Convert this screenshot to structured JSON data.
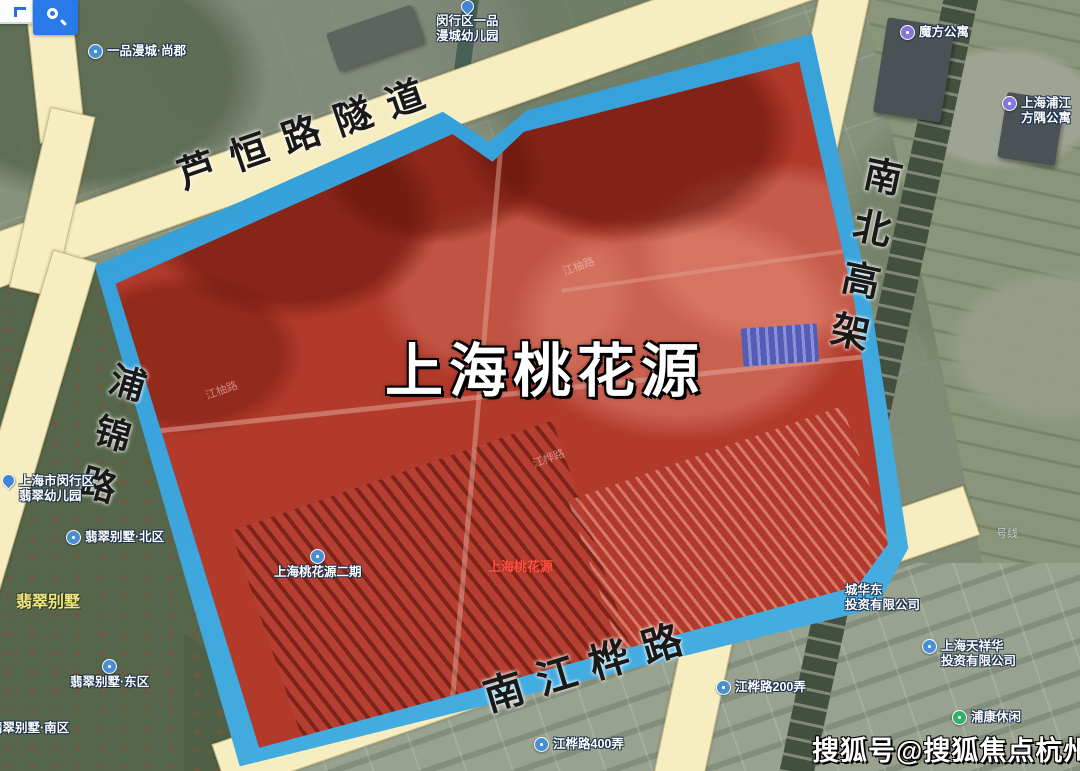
{
  "map": {
    "region": {
      "name": "上海桃花源",
      "overlay_color": "#b23a2b",
      "boundary_color": "#3aa9e0",
      "road_color": "#f6edc0"
    },
    "roads": [
      {
        "name": "芦恒路隧道"
      },
      {
        "name": "南北高架"
      },
      {
        "name": "浦锦路"
      },
      {
        "name": "南江桦路"
      }
    ],
    "pois": [
      {
        "id": "yipin-mancheng-shangjun",
        "lines": [
          "一品漫城·尚郡"
        ],
        "marker": "circle-blue",
        "markerPos": "left",
        "x": 88,
        "y": 44
      },
      {
        "id": "minhang-kindergarten",
        "lines": [
          "闵行区一品",
          "漫城幼儿园"
        ],
        "marker": "pin-blue",
        "markerPos": "above",
        "x": 436,
        "y": 0
      },
      {
        "id": "mofang-apartment",
        "lines": [
          "魔方公寓"
        ],
        "marker": "circle-purple",
        "markerPos": "left",
        "x": 900,
        "y": 25
      },
      {
        "id": "pujiang-funyard",
        "lines": [
          "上海浦江",
          "方隅公寓"
        ],
        "marker": "circle-purple",
        "markerPos": "left",
        "x": 1002,
        "y": 96
      },
      {
        "id": "feicui-kindergarten",
        "lines": [
          "上海市闵行区",
          "翡翠幼儿园"
        ],
        "marker": "pin-blue",
        "markerPos": "left",
        "x": 2,
        "y": 474
      },
      {
        "id": "feicui-villa-north",
        "lines": [
          "翡翠别墅·北区"
        ],
        "marker": "circle-blue",
        "markerPos": "left",
        "x": 66,
        "y": 530
      },
      {
        "id": "feicui-villa",
        "lines": [
          "翡翠别墅"
        ],
        "marker": null,
        "style": "yellow",
        "x": 16,
        "y": 594
      },
      {
        "id": "feicui-villa-east",
        "lines": [
          "翡翠别墅·东区"
        ],
        "marker": "circle-blue",
        "markerPos": "above",
        "x": 70,
        "y": 659
      },
      {
        "id": "feicui-villa-south",
        "lines": [
          "翡翠别墅·南区"
        ],
        "marker": null,
        "x": -10,
        "y": 721
      },
      {
        "id": "taohuayuan-phase2",
        "lines": [
          "上海桃花源二期"
        ],
        "marker": "circle-blue",
        "markerPos": "above",
        "x": 274,
        "y": 549
      },
      {
        "id": "taohuayuan-red",
        "lines": [
          "上海桃花源"
        ],
        "marker": null,
        "style": "red",
        "x": 488,
        "y": 559
      },
      {
        "id": "chenghuadong-invest",
        "lines": [
          "城华东",
          "投资有限公司"
        ],
        "marker": null,
        "x": 845,
        "y": 583
      },
      {
        "id": "tianxianghua-invest",
        "lines": [
          "上海天祥华",
          "投资有限公司"
        ],
        "marker": "circle-blue",
        "markerPos": "left",
        "x": 922,
        "y": 639
      },
      {
        "id": "jianghua-road-200",
        "lines": [
          "江桦路200弄"
        ],
        "marker": "circle-blue",
        "markerPos": "left",
        "x": 716,
        "y": 680
      },
      {
        "id": "jianghua-road-400",
        "lines": [
          "江桦路400弄"
        ],
        "marker": "circle-blue",
        "markerPos": "left",
        "x": 534,
        "y": 737
      },
      {
        "id": "pukang-leisure",
        "lines": [
          "浦康休闲"
        ],
        "marker": "circle-green",
        "markerPos": "left",
        "x": 952,
        "y": 710
      },
      {
        "id": "metro-line",
        "lines": [
          "号线"
        ],
        "marker": null,
        "style": "faint",
        "x": 996,
        "y": 528
      }
    ],
    "faint_road_labels": [
      {
        "text": "江柚路",
        "x": 562,
        "y": 258,
        "rot": -20
      },
      {
        "text": "江柚路",
        "x": 205,
        "y": 382,
        "rot": -20
      },
      {
        "text": "江桦路",
        "x": 532,
        "y": 450,
        "rot": -20
      }
    ]
  },
  "watermark": {
    "text": "搜狐号@搜狐焦点杭州站"
  },
  "ui": {
    "search_icon": "magnifier"
  }
}
